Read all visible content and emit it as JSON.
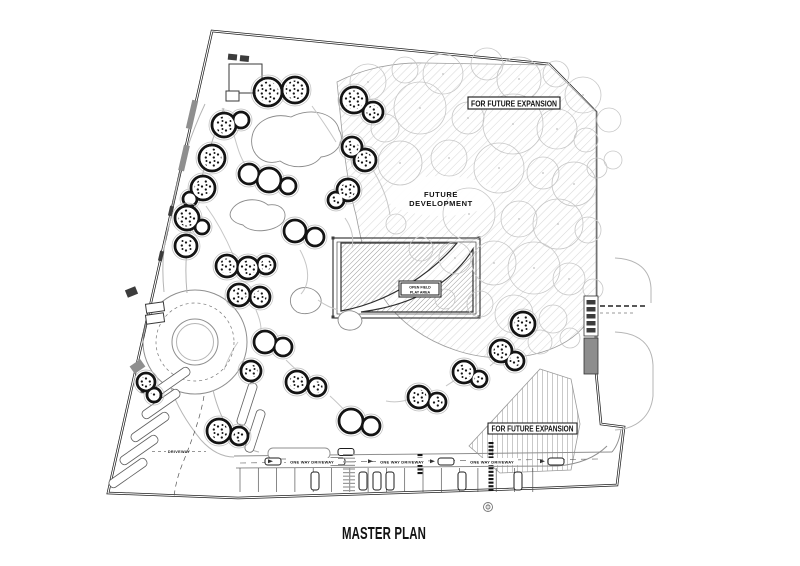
{
  "drawing": {
    "title": "MASTER PLAN",
    "labels": {
      "expansion_top": "FOR FUTURE EXPANSION",
      "expansion_bottom": "FOR FUTURE EXPANSION",
      "development_line1": "FUTURE",
      "development_line2": "DEVELOPMENT",
      "play_line1": "OPEN FIELD",
      "play_line2": "PLAY AREA",
      "one_way": "ONE WAY DRIVEWAY",
      "driveway": "DRIVEWAY"
    },
    "colors": {
      "ink": "#161616",
      "boundary": "#1f1f1f",
      "tree_line": "#c7c7c7",
      "hatch_light": "#d9d9d9",
      "hatch_dark": "#9c9c9c",
      "hatch_vertical": "#c9c9c9",
      "gate_gray": "#8d8d8d",
      "paper": "#ffffff"
    },
    "plan": {
      "trees": [
        [
          368,
          82,
          18
        ],
        [
          405,
          70,
          13
        ],
        [
          443,
          74,
          20
        ],
        [
          487,
          64,
          16
        ],
        [
          519,
          79,
          22
        ],
        [
          556,
          74,
          13
        ],
        [
          583,
          95,
          18
        ],
        [
          420,
          108,
          26
        ],
        [
          468,
          118,
          16
        ],
        [
          513,
          124,
          30
        ],
        [
          557,
          129,
          20
        ],
        [
          586,
          140,
          12
        ],
        [
          385,
          128,
          14
        ],
        [
          362,
          158,
          11
        ],
        [
          400,
          163,
          22
        ],
        [
          449,
          158,
          18
        ],
        [
          499,
          168,
          25
        ],
        [
          543,
          173,
          16
        ],
        [
          574,
          184,
          22
        ],
        [
          597,
          168,
          10
        ],
        [
          469,
          214,
          26
        ],
        [
          519,
          219,
          18
        ],
        [
          558,
          224,
          25
        ],
        [
          588,
          230,
          13
        ],
        [
          455,
          258,
          16
        ],
        [
          494,
          263,
          22
        ],
        [
          534,
          268,
          26
        ],
        [
          569,
          279,
          16
        ],
        [
          593,
          289,
          10
        ],
        [
          480,
          304,
          13
        ],
        [
          514,
          314,
          19
        ],
        [
          553,
          319,
          14
        ],
        [
          445,
          299,
          10
        ],
        [
          421,
          249,
          12
        ],
        [
          396,
          224,
          10
        ],
        [
          609,
          120,
          12
        ],
        [
          613,
          160,
          9
        ],
        [
          540,
          342,
          12
        ],
        [
          570,
          338,
          10
        ]
      ],
      "building_clusters": [
        [
          [
            268,
            92,
            14,
            1
          ],
          [
            295,
            90,
            13,
            1
          ]
        ],
        [
          [
            354,
            100,
            13,
            1
          ],
          [
            373,
            112,
            10,
            1
          ]
        ],
        [
          [
            224,
            125,
            12,
            1
          ],
          [
            241,
            120,
            8,
            0
          ]
        ],
        [
          [
            212,
            158,
            13,
            1
          ]
        ],
        [
          [
            203,
            188,
            12,
            1
          ],
          [
            190,
            199,
            7,
            0
          ]
        ],
        [
          [
            249,
            174,
            10,
            0
          ],
          [
            269,
            180,
            12,
            0
          ],
          [
            288,
            186,
            8,
            0
          ]
        ],
        [
          [
            352,
            147,
            10,
            1
          ],
          [
            365,
            160,
            11,
            1
          ]
        ],
        [
          [
            348,
            190,
            11,
            1
          ],
          [
            336,
            200,
            8,
            1
          ]
        ],
        [
          [
            187,
            218,
            12,
            1
          ],
          [
            202,
            227,
            7,
            0
          ]
        ],
        [
          [
            186,
            246,
            11,
            1
          ]
        ],
        [
          [
            227,
            266,
            11,
            1
          ],
          [
            248,
            268,
            11,
            1
          ],
          [
            266,
            265,
            9,
            1
          ]
        ],
        [
          [
            239,
            295,
            11,
            1
          ],
          [
            260,
            297,
            10,
            1
          ]
        ],
        [
          [
            295,
            231,
            11,
            0
          ],
          [
            315,
            237,
            9,
            0
          ]
        ],
        [
          [
            523,
            324,
            12,
            1
          ]
        ],
        [
          [
            501,
            351,
            11,
            1
          ],
          [
            515,
            361,
            9,
            1
          ]
        ],
        [
          [
            265,
            342,
            11,
            0
          ],
          [
            283,
            347,
            9,
            0
          ]
        ],
        [
          [
            251,
            371,
            10,
            1
          ]
        ],
        [
          [
            297,
            382,
            11,
            1
          ],
          [
            317,
            387,
            9,
            1
          ]
        ],
        [
          [
            419,
            397,
            11,
            1
          ],
          [
            437,
            402,
            9,
            1
          ]
        ],
        [
          [
            464,
            372,
            11,
            1
          ],
          [
            479,
            379,
            8,
            1
          ]
        ],
        [
          [
            219,
            431,
            12,
            1
          ],
          [
            239,
            436,
            9,
            1
          ]
        ],
        [
          [
            351,
            421,
            12,
            0
          ],
          [
            371,
            426,
            9,
            0
          ]
        ],
        [
          [
            146,
            382,
            9,
            1
          ],
          [
            154,
            395,
            7,
            1
          ]
        ]
      ],
      "parking": {
        "x0": 240,
        "x1": 533,
        "step": 18.3,
        "y_top": 468,
        "y_bottom": 492
      },
      "stall_cars": [
        315,
        363,
        377,
        390,
        462,
        518
      ],
      "lane_cars": [
        273,
        337,
        446,
        556
      ],
      "lane_car_y": 458,
      "one_way_label_xs": [
        312,
        402,
        492
      ],
      "arrow_xs": [
        268,
        368,
        430,
        540
      ],
      "crosswalks": [
        [
          349,
          454,
          492,
          0
        ],
        [
          491,
          442,
          490,
          1
        ],
        [
          420,
          454,
          474,
          1
        ]
      ],
      "strips": [
        [
          128,
          473,
          -35
        ],
        [
          139,
          450,
          -35
        ],
        [
          150,
          427,
          -35
        ],
        [
          161,
          404,
          -35
        ],
        [
          171,
          382,
          -35
        ],
        [
          247,
          404,
          -72
        ],
        [
          255,
          431,
          -72
        ]
      ]
    }
  }
}
